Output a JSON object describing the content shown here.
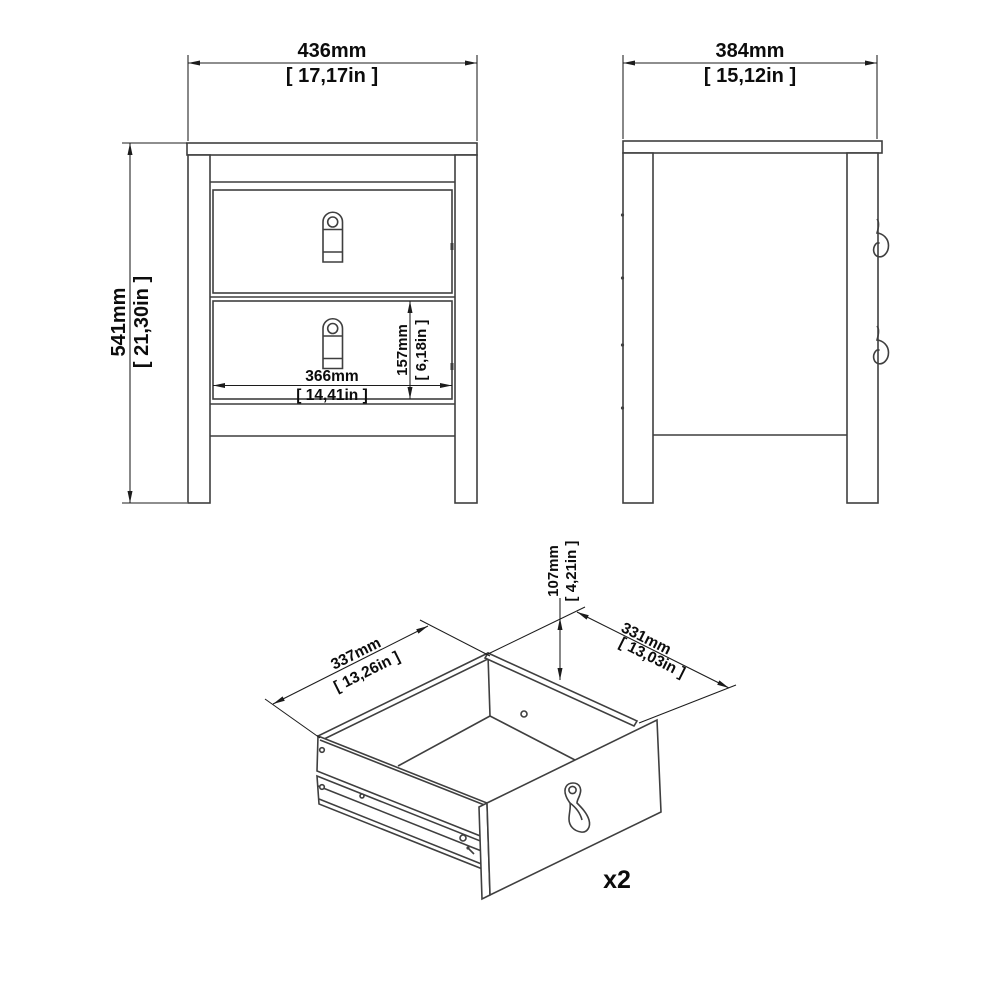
{
  "drawing_type": "furniture-dimension-diagram",
  "views": {
    "front": {
      "width_mm": "436mm",
      "width_in": "[ 17,17in ]",
      "height_mm": "541mm",
      "height_in": "[ 21,30in ]",
      "drawer_width_mm": "366mm",
      "drawer_width_in": "[ 14,41in ]",
      "drawer_height_mm": "157mm",
      "drawer_height_in": "[ 6,18in ]"
    },
    "side": {
      "depth_mm": "384mm",
      "depth_in": "[ 15,12in ]"
    },
    "drawer": {
      "width_mm": "337mm",
      "width_in": "[ 13,26in ]",
      "depth_mm": "331mm",
      "depth_in": "[ 13,03in ]",
      "height_mm": "107mm",
      "height_in": "[ 4,21in ]",
      "quantity": "x2"
    }
  },
  "colors": {
    "line": "#3f3f3f",
    "dimension": "#1c1c1c",
    "background": "#ffffff"
  }
}
